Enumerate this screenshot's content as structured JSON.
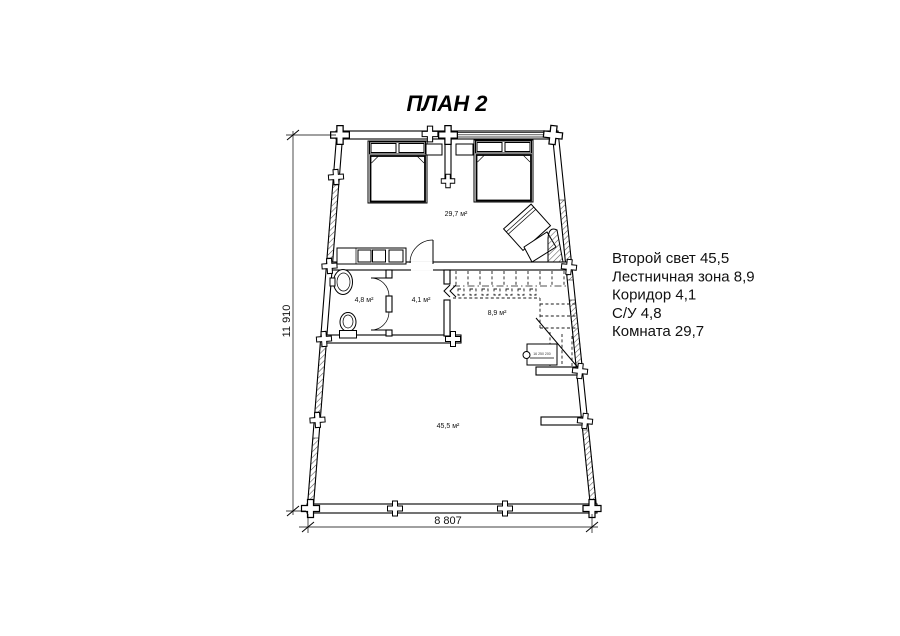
{
  "title": "ПЛАН 2",
  "dimensions": {
    "vertical": "11 910",
    "horizontal": "8 807"
  },
  "room_labels": {
    "bedroom": "29,7 м²",
    "bathroom": "4,8 м²",
    "corridor": "4,1 м²",
    "stair_zone": "8,9 м²",
    "second_light": "45,5 м²"
  },
  "stair_note": "16 250 200",
  "legend": {
    "lines": [
      "Второй свет 45,5",
      "Лестничная зона 8,9",
      "Коридор 4,1",
      "С/У 4,8",
      "Комната 29,7"
    ]
  },
  "colors": {
    "ink": "#000000",
    "paper": "#ffffff"
  }
}
